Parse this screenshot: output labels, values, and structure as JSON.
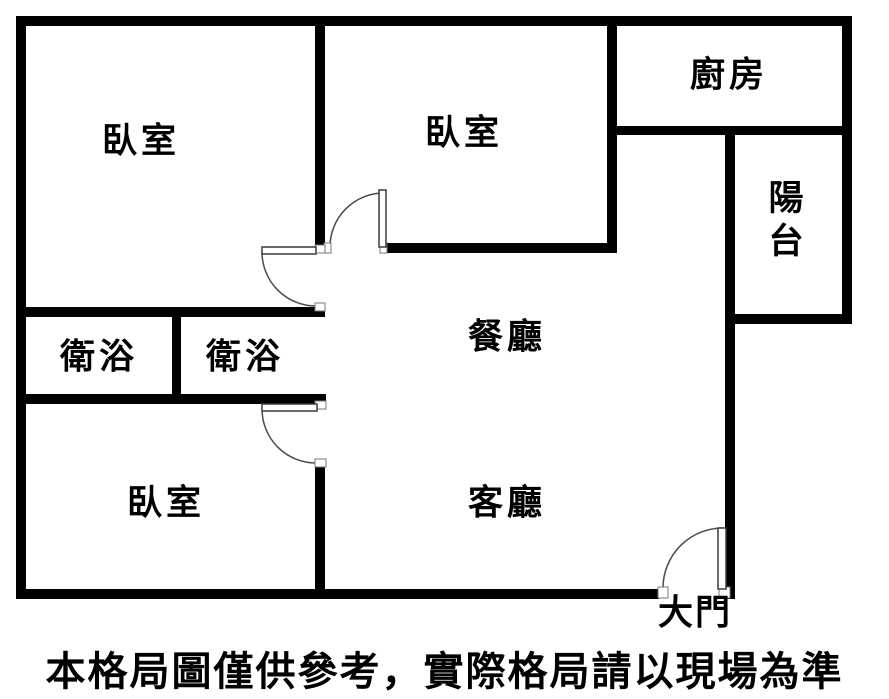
{
  "floorplan": {
    "rooms": {
      "bedroom_top_left": "臥室",
      "bedroom_top_middle": "臥室",
      "bedroom_bottom": "臥室",
      "kitchen": "廚房",
      "balcony": "陽台",
      "bathroom_left": "衛浴",
      "bathroom_right": "衛浴",
      "dining": "餐廳",
      "living": "客廳",
      "main_door": "大門"
    },
    "disclaimer": "本格局圖僅供參考，實際格局請以現場為準",
    "colors": {
      "wall": "#000000",
      "background": "#ffffff",
      "door_line": "#4a4a4a"
    }
  }
}
